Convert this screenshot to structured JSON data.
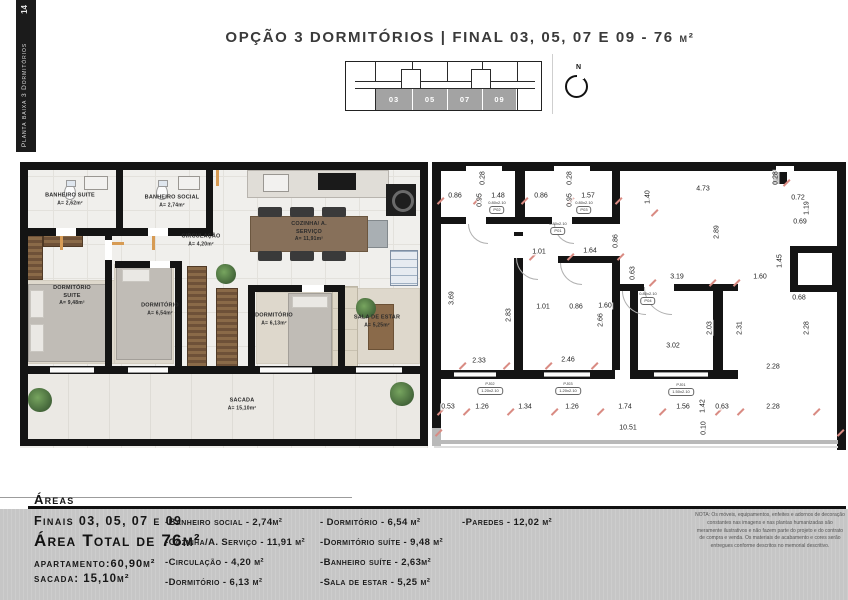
{
  "sidebar": {
    "page_number": "14",
    "label": "Planta baixa 3 Dormitórios"
  },
  "header": {
    "title": "OPÇÃO 3 DORMITÓRIOS | FINAL 03, 05, 07 E 09 - 76 ",
    "unit": "m²"
  },
  "keyplan": {
    "north_label": "N",
    "units": [
      {
        "t": "03",
        "x": 31,
        "y": 31,
        "w": 36
      },
      {
        "t": "05",
        "x": 68,
        "y": 31,
        "w": 34
      },
      {
        "t": "07",
        "x": 103,
        "y": 31,
        "w": 34
      },
      {
        "t": "09",
        "x": 138,
        "y": 31,
        "w": 33
      }
    ]
  },
  "rendered_plan": {
    "rooms": [
      {
        "name": "BANHEIRO SUITE",
        "area": "A= 2,62m²",
        "x": 50,
        "y": 38
      },
      {
        "name": "BANHEIRO SOCIAL",
        "area": "A= 2,74m²",
        "x": 152,
        "y": 40
      },
      {
        "name": "CIRCULAÇÃO",
        "area": "A= 4,20m²",
        "x": 181,
        "y": 79
      },
      {
        "name": "DORMITÓRIO SUITE",
        "area": "A= 9,48m²",
        "x": 52,
        "y": 134,
        "w": 1
      },
      {
        "name": "DORMITÓRIO",
        "area": "A= 6,54m²",
        "x": 140,
        "y": 148
      },
      {
        "name": "COZINHA/ A. SERVIÇO",
        "area": "A= 11,91m²",
        "x": 289,
        "y": 70,
        "w": 1
      },
      {
        "name": "DORMITÓRIO",
        "area": "A= 6,13m²",
        "x": 254,
        "y": 158
      },
      {
        "name": "SALA DE ESTAR",
        "area": "A= 5,25m²",
        "x": 357,
        "y": 160
      },
      {
        "name": "SACADA",
        "area": "A= 15,10m²",
        "x": 222,
        "y": 243
      }
    ]
  },
  "tech_plan": {
    "dims": [
      {
        "t": "0.86",
        "x": 23,
        "y": 36
      },
      {
        "t": "0.28",
        "x": 51,
        "y": 18,
        "r": 1
      },
      {
        "t": "0.95",
        "x": 48,
        "y": 40,
        "r": 1
      },
      {
        "t": "1.48",
        "x": 66,
        "y": 36
      },
      {
        "t": "0.86",
        "x": 109,
        "y": 36
      },
      {
        "t": "0.28",
        "x": 138,
        "y": 18,
        "r": 1
      },
      {
        "t": "0.95",
        "x": 138,
        "y": 40,
        "r": 1
      },
      {
        "t": "1.57",
        "x": 156,
        "y": 36
      },
      {
        "t": "1.40",
        "x": 216,
        "y": 37,
        "r": 1
      },
      {
        "t": "4.73",
        "x": 271,
        "y": 29
      },
      {
        "t": "0.28",
        "x": 344,
        "y": 18,
        "r": 1
      },
      {
        "t": "0.72",
        "x": 366,
        "y": 38
      },
      {
        "t": "1.19",
        "x": 375,
        "y": 48,
        "r": 1
      },
      {
        "t": "0.69",
        "x": 368,
        "y": 62
      },
      {
        "t": "1.01",
        "x": 107,
        "y": 92
      },
      {
        "t": "1.64",
        "x": 158,
        "y": 91
      },
      {
        "t": "0.86",
        "x": 184,
        "y": 81,
        "r": 1
      },
      {
        "t": "2.89",
        "x": 285,
        "y": 72,
        "r": 1
      },
      {
        "t": "0.63",
        "x": 201,
        "y": 113,
        "r": 1
      },
      {
        "t": "3.19",
        "x": 245,
        "y": 117
      },
      {
        "t": "1.60",
        "x": 328,
        "y": 117
      },
      {
        "t": "1.45",
        "x": 348,
        "y": 101,
        "r": 1
      },
      {
        "t": "3.69",
        "x": 20,
        "y": 138,
        "r": 1
      },
      {
        "t": "2.83",
        "x": 77,
        "y": 155,
        "r": 1
      },
      {
        "t": "1.01",
        "x": 111,
        "y": 147
      },
      {
        "t": "0.86",
        "x": 144,
        "y": 147
      },
      {
        "t": "1.60",
        "x": 173,
        "y": 146
      },
      {
        "t": "2.66",
        "x": 169,
        "y": 160,
        "r": 1
      },
      {
        "t": "0.68",
        "x": 367,
        "y": 138
      },
      {
        "t": "2.03",
        "x": 278,
        "y": 168,
        "r": 1
      },
      {
        "t": "2.31",
        "x": 308,
        "y": 168,
        "r": 1
      },
      {
        "t": "2.28",
        "x": 375,
        "y": 168,
        "r": 1
      },
      {
        "t": "3.02",
        "x": 241,
        "y": 186
      },
      {
        "t": "2.33",
        "x": 47,
        "y": 201
      },
      {
        "t": "2.46",
        "x": 136,
        "y": 200
      },
      {
        "t": "2.28",
        "x": 341,
        "y": 207
      },
      {
        "t": "0.53",
        "x": 16,
        "y": 247
      },
      {
        "t": "1.26",
        "x": 50,
        "y": 247
      },
      {
        "t": "1.34",
        "x": 93,
        "y": 247
      },
      {
        "t": "1.26",
        "x": 140,
        "y": 247
      },
      {
        "t": "1.74",
        "x": 193,
        "y": 247
      },
      {
        "t": "1.56",
        "x": 251,
        "y": 247
      },
      {
        "t": "1.42",
        "x": 271,
        "y": 246,
        "r": 1
      },
      {
        "t": "0.63",
        "x": 290,
        "y": 247
      },
      {
        "t": "2.28",
        "x": 341,
        "y": 247
      },
      {
        "t": "10.51",
        "x": 196,
        "y": 268
      },
      {
        "t": "0.10",
        "x": 272,
        "y": 268,
        "r": 1
      }
    ],
    "tags": [
      {
        "a": "0.80x2.10",
        "b": "P02",
        "x": 65,
        "y": 47
      },
      {
        "a": "0.80x2.10",
        "b": "P03",
        "x": 152,
        "y": 47
      },
      {
        "a": "0.80x2.10",
        "b": "P01",
        "x": 126,
        "y": 68
      },
      {
        "a": "0.80x2.10",
        "b": "P04",
        "x": 216,
        "y": 138
      },
      {
        "a": "PJ02",
        "b": "1.20x2.10",
        "x": 58,
        "y": 228
      },
      {
        "a": "PJ03",
        "b": "1.20x2.10",
        "x": 136,
        "y": 228
      },
      {
        "a": "PJ01",
        "b": "1.50x2.10",
        "x": 249,
        "y": 229
      }
    ],
    "ticks": [
      {
        "x": 4,
        "y": 40
      },
      {
        "x": 40,
        "y": 40
      },
      {
        "x": 88,
        "y": 40
      },
      {
        "x": 134,
        "y": 40
      },
      {
        "x": 182,
        "y": 40
      },
      {
        "x": 350,
        "y": 22
      },
      {
        "x": 218,
        "y": 52
      },
      {
        "x": 96,
        "y": 96
      },
      {
        "x": 134,
        "y": 96
      },
      {
        "x": 184,
        "y": 96
      },
      {
        "x": 216,
        "y": 122
      },
      {
        "x": 276,
        "y": 122
      },
      {
        "x": 300,
        "y": 122
      },
      {
        "x": 26,
        "y": 205
      },
      {
        "x": 70,
        "y": 205
      },
      {
        "x": 112,
        "y": 205
      },
      {
        "x": 158,
        "y": 205
      },
      {
        "x": 4,
        "y": 251
      },
      {
        "x": 30,
        "y": 251
      },
      {
        "x": 74,
        "y": 251
      },
      {
        "x": 118,
        "y": 251
      },
      {
        "x": 164,
        "y": 251
      },
      {
        "x": 226,
        "y": 251
      },
      {
        "x": 282,
        "y": 251
      },
      {
        "x": 304,
        "y": 251
      },
      {
        "x": 380,
        "y": 251
      },
      {
        "x": 2,
        "y": 272
      },
      {
        "x": 404,
        "y": 272
      }
    ]
  },
  "footer": {
    "areas_title": "Áreas",
    "finals": "Finais 03, 05, 07 e 09",
    "total": "Área Total de 76m²",
    "apartment": "apartamento:60,90m²",
    "sacada": "sacada: 15,10m²",
    "col1": [
      {
        "t": "-Banheiro social - 2,74m²"
      },
      {
        "t": "-Cozinha/A. Serviço - 11,91 m²"
      },
      {
        "t": "-Circulação - 4,20 m²"
      },
      {
        "t": "-Dormitório - 6,13 m²"
      }
    ],
    "col2": [
      {
        "t": "- Dormitório - 6,54 m²"
      },
      {
        "t": "-Dormitório suíte - 9,48 m²"
      },
      {
        "t": "-Banheiro suíte - 2,63m²"
      },
      {
        "t": "-Sala de estar - 5,25 m²"
      }
    ],
    "col3": [
      {
        "t": "-Paredes - 12,02 m²"
      }
    ],
    "note": "NOTA: Os móveis, equipamentos, enfeites e adornos de decoração constantes nas imagens e nas plantas humanizadas são meramente ilustrativos e não fazem parte do projeto e do contrato de compra e venda. Os materiais de acabamento e cores serão entregues conforme descritos no memorial descritivo."
  }
}
